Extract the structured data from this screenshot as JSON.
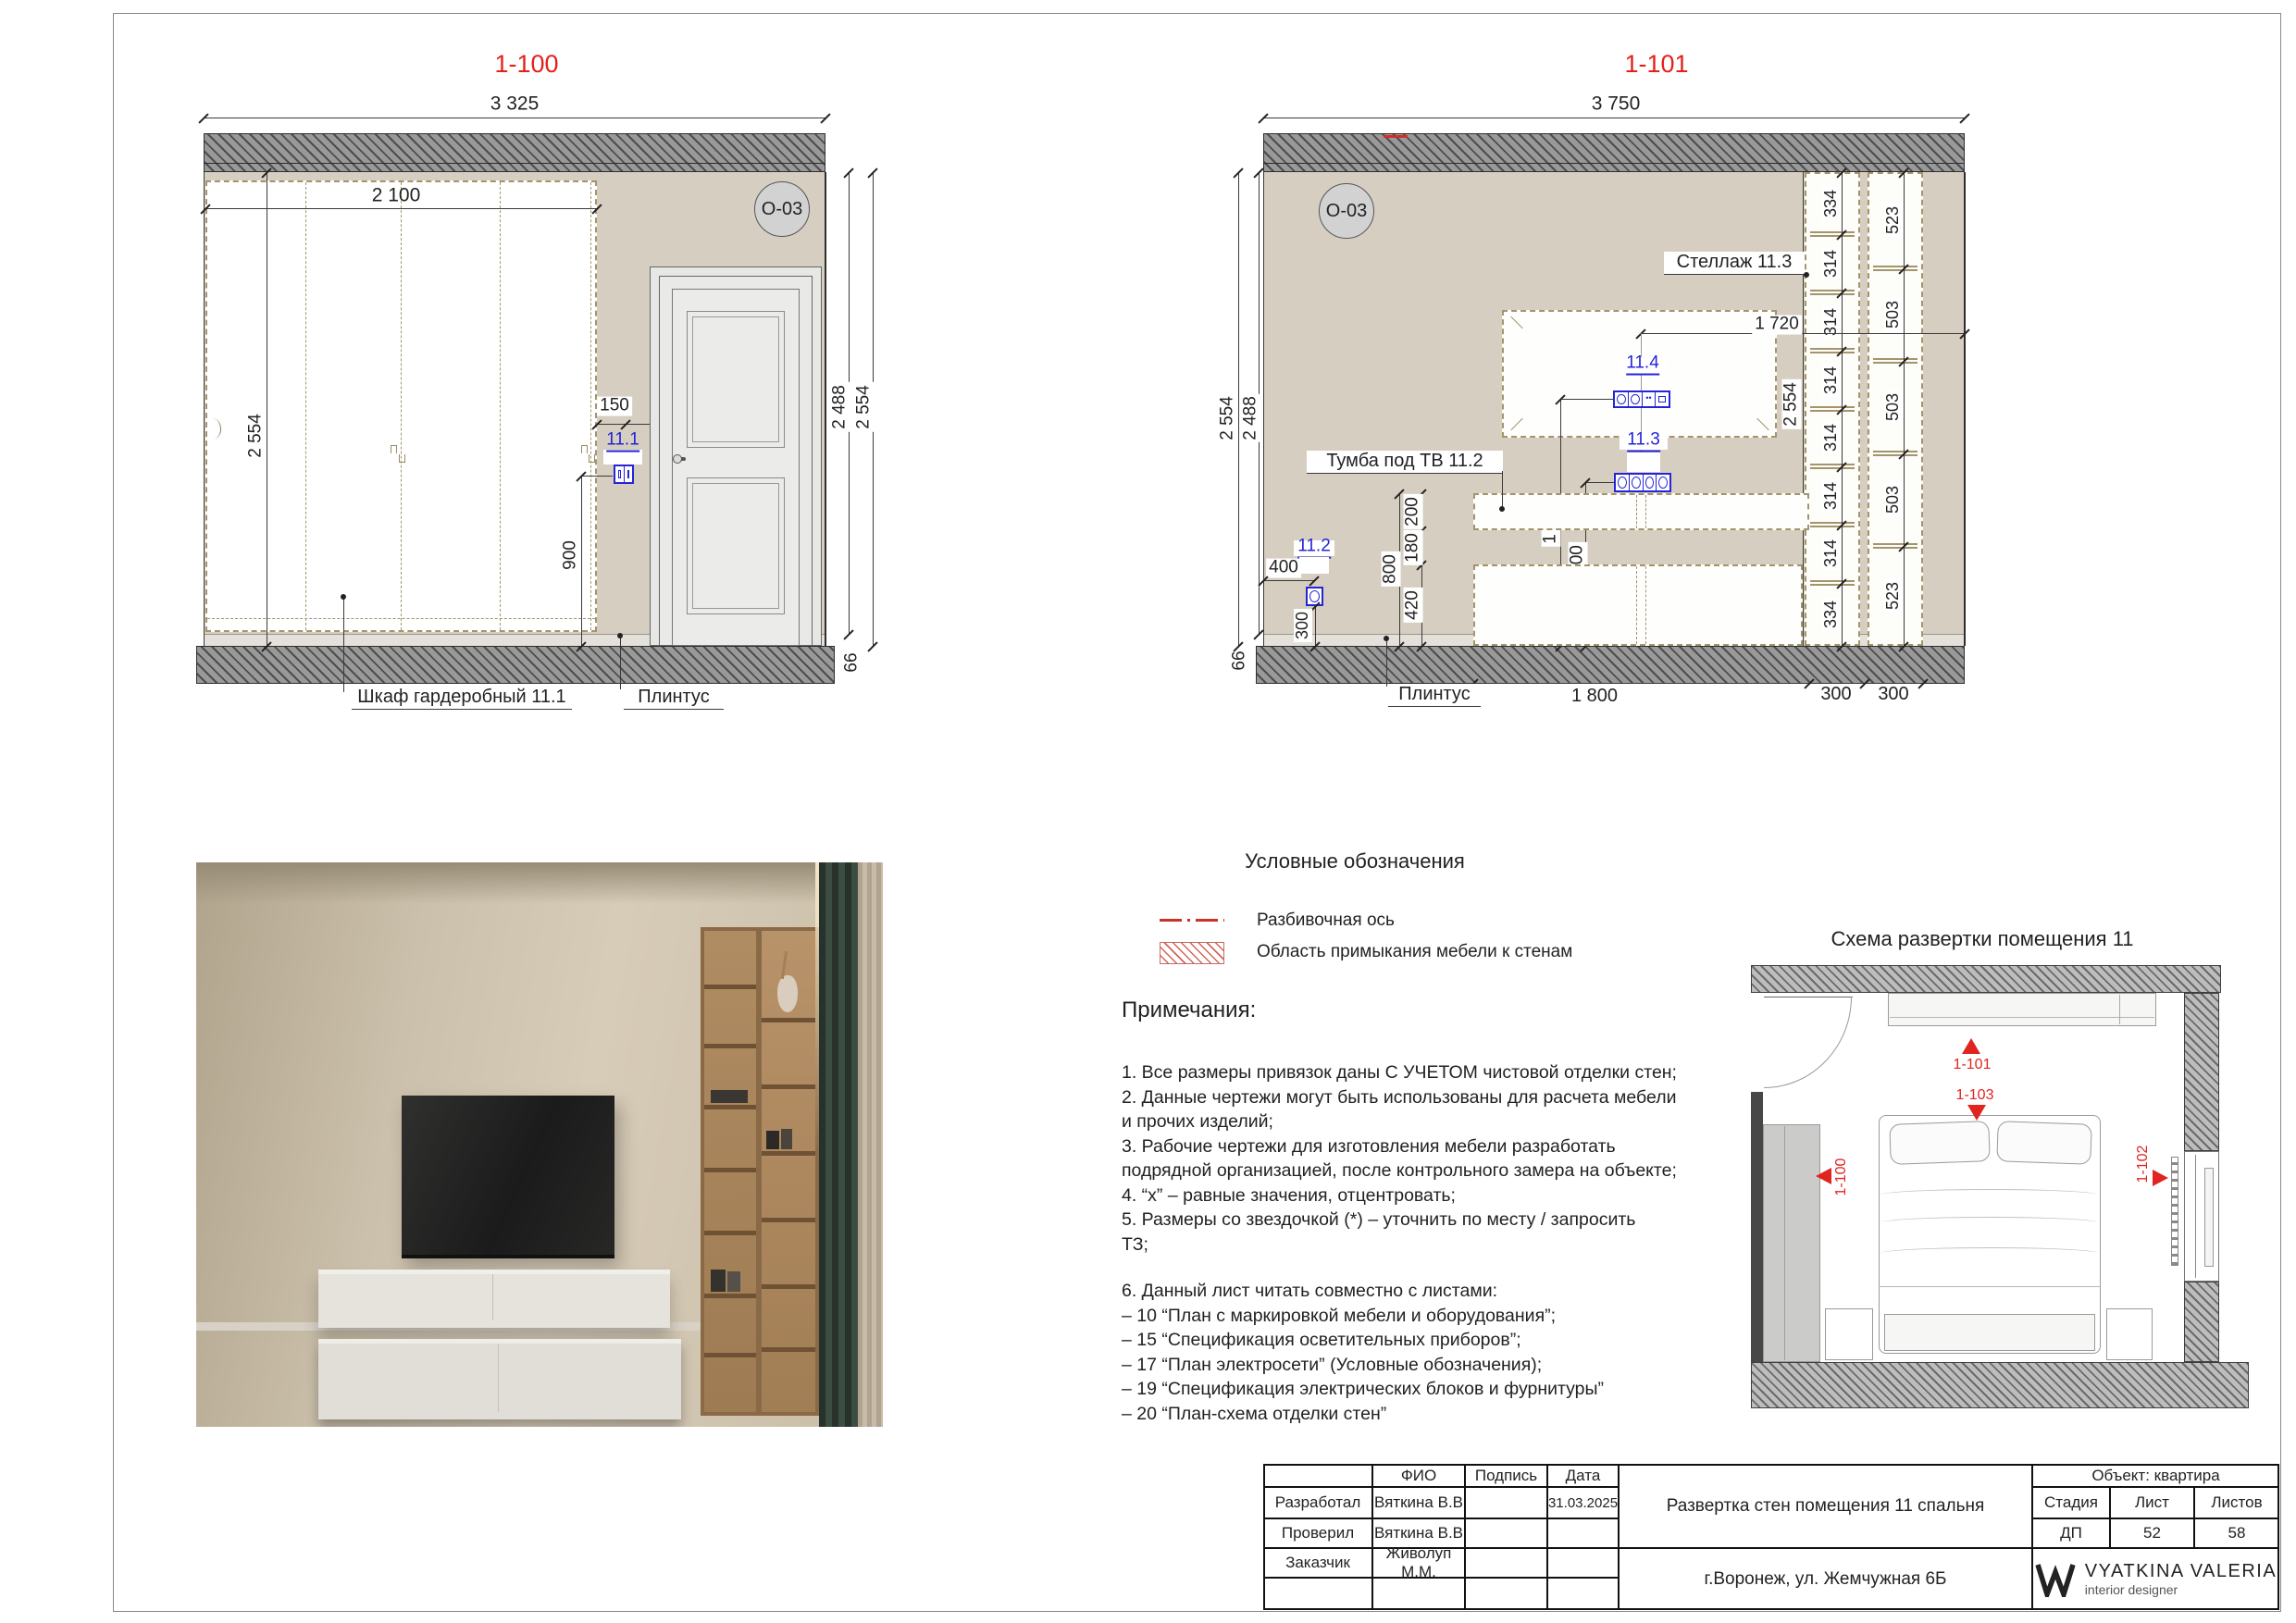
{
  "d100": {
    "title": "1-100",
    "marker": "O-03",
    "dims": {
      "width": "3 325",
      "inner_width": "2 100",
      "height_left": "2 554",
      "h_right_inner": "2 488",
      "h_right_outer": "2 554",
      "d150": "150",
      "d900": "900",
      "d66": "66"
    },
    "refs": {
      "r111": "11.1"
    },
    "labels": {
      "wardrobe": "Шкаф гардеробный 11.1",
      "plinth": "Плинтус"
    }
  },
  "d101": {
    "title": "1-101",
    "marker": "O-03",
    "dims": {
      "width": "3 750",
      "height_left_outer": "2 554",
      "height_left_inner": "2 488",
      "d66": "66",
      "d1720": "1 720",
      "height_inner": "2 554",
      "d1300": "1 300",
      "d900": "900",
      "d800": "800",
      "d200": "200",
      "d180": "180",
      "d420": "420",
      "d400": "400",
      "d300": "300",
      "bottom": [
        "1 800",
        "300",
        "300"
      ],
      "chain_inner": [
        "334",
        "314",
        "314",
        "314",
        "314",
        "314",
        "314",
        "334"
      ],
      "chain_outer": [
        "523",
        "503",
        "503",
        "503",
        "523"
      ]
    },
    "refs": {
      "r112": "11.2",
      "r113": "11.3",
      "r114": "11.4"
    },
    "labels": {
      "shelf": "Стеллаж  11.3",
      "tv_stand": "Тумба под ТВ  11.2",
      "plinth": "Плинтус"
    }
  },
  "legend": {
    "title": "Условные обозначения",
    "axis_label": "Разбивочная ось",
    "area_label": "Область примыкания мебели к стенам"
  },
  "notes": {
    "title": "Примечания:",
    "lines": [
      "1. Все размеры привязок даны С УЧЕТОМ чистовой отделки стен;",
      "2. Данные чертежи могут быть использованы для расчета мебели",
      "и прочих изделий;",
      "3. Рабочие чертежи для изготовления мебели разработать",
      "подрядной организацией, после контрольного замера на объекте;",
      "4. “х” – равные значения, отцентровать;",
      "5. Размеры со звездочкой (*) – уточнить по месту / запросить",
      "ТЗ;",
      "",
      "6. Данный лист читать совместно с листами:",
      "– 10 “План с маркировкой мебели и оборудования”;",
      "– 15 “Спецификация осветительных приборов”;",
      "– 17 “План электросети” (Условные обозначения);",
      "– 19 “Спецификация электрических блоков и фурнитуры”",
      "– 20 “План-схема отделки стен”"
    ]
  },
  "scheme": {
    "title": "Схема развертки помещения 11",
    "markers": [
      "1-101",
      "1-103",
      "1-100",
      "1-102"
    ]
  },
  "titleblock": {
    "rows": [
      [
        "",
        "ФИО",
        "Подпись",
        "Дата"
      ],
      [
        "Разработал",
        "Вяткина В.В",
        "",
        "31.03.2025"
      ],
      [
        "Проверил",
        "Вяткина В.В",
        "",
        ""
      ],
      [
        "Заказчик",
        "Живолуп М.М.",
        "",
        ""
      ],
      [
        "",
        "",
        "",
        ""
      ]
    ],
    "object": "Объект: квартира",
    "stage_h": "Стадия",
    "sheet_h": "Лист",
    "sheets_h": "Листов",
    "stage": "ДП",
    "sheet_no": "52",
    "sheets_total": "58",
    "doc_title": "Развертка стен помещения 11 спальня",
    "address": "г.Воронеж, ул. Жемчужная 6Б",
    "logo_name": "VYATKINA VALERIA",
    "logo_sub": "interior designer"
  }
}
